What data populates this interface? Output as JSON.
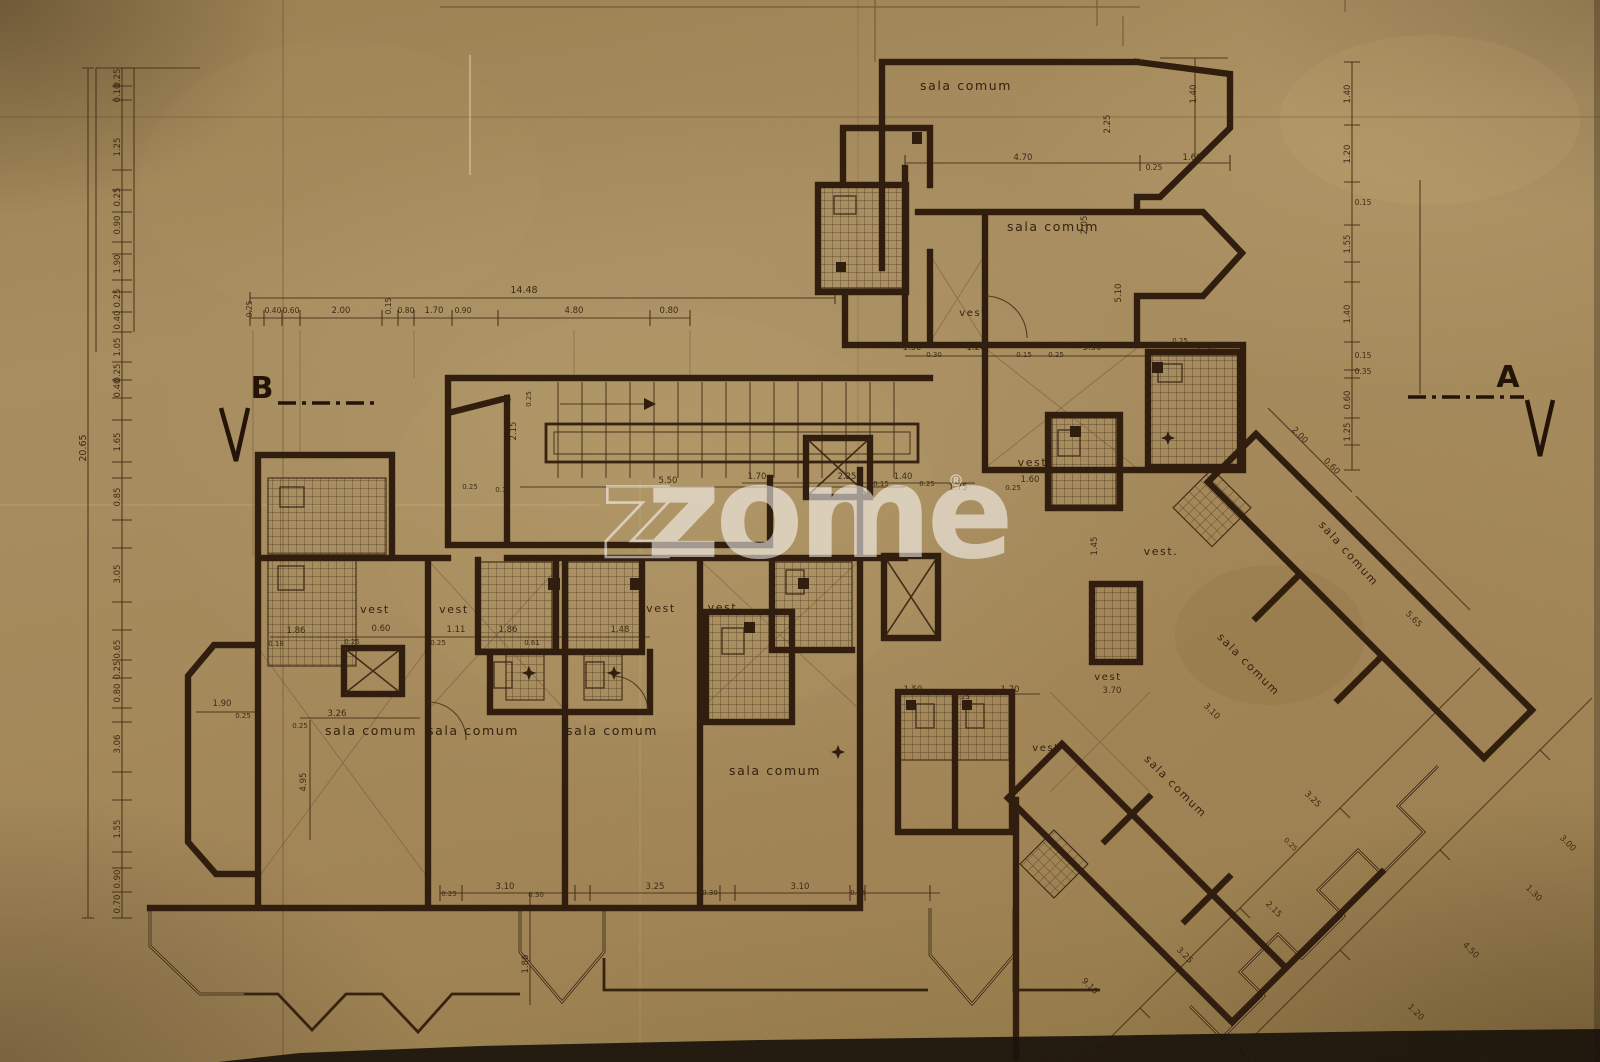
{
  "meta": {
    "drawing_type": "Scanned architectural floor plan blueprint",
    "paper_color": "#a78c5e",
    "ink_color": "#2e1b0c"
  },
  "watermark": {
    "z_outline": "z",
    "text": "zome",
    "registered": "®"
  },
  "section_markers": {
    "left": {
      "label": "B"
    },
    "right": {
      "label": "A"
    }
  },
  "room_labels": [
    {
      "t": "sala comum",
      "x": 966,
      "y": 90
    },
    {
      "t": "sala comum",
      "x": 1053,
      "y": 231
    },
    {
      "t": "vest",
      "x": 973,
      "y": 316,
      "s": 10
    },
    {
      "t": "vest.",
      "x": 1035,
      "y": 466,
      "s": 11
    },
    {
      "t": "vest.",
      "x": 1161,
      "y": 555,
      "s": 11
    },
    {
      "t": "vest",
      "x": 1108,
      "y": 680,
      "s": 10
    },
    {
      "t": "vest",
      "x": 1046,
      "y": 751,
      "s": 10
    },
    {
      "t": "vest",
      "x": 375,
      "y": 613,
      "s": 11
    },
    {
      "t": "vest",
      "x": 454,
      "y": 613,
      "s": 11
    },
    {
      "t": "vest",
      "x": 661,
      "y": 612,
      "s": 11
    },
    {
      "t": "vest.",
      "x": 725,
      "y": 611,
      "s": 11
    },
    {
      "t": "sala comum",
      "x": 371,
      "y": 735
    },
    {
      "t": "sala comum",
      "x": 473,
      "y": 735
    },
    {
      "t": "sala comum",
      "x": 612,
      "y": 735
    },
    {
      "t": "sala comum",
      "x": 775,
      "y": 775
    },
    {
      "t": "sala comum",
      "x": 1346,
      "y": 556,
      "r": 48,
      "s": 11
    },
    {
      "t": "sala comum",
      "x": 1246,
      "y": 667,
      "r": 45,
      "s": 11
    },
    {
      "t": "sala comum",
      "x": 1173,
      "y": 789,
      "r": 45,
      "s": 11
    }
  ],
  "dimension_labels": [
    {
      "t": "0.25",
      "x": 120,
      "y": 78,
      "r": -90
    },
    {
      "t": "0.10",
      "x": 120,
      "y": 93,
      "r": -90
    },
    {
      "t": "1.25",
      "x": 120,
      "y": 147,
      "r": -90
    },
    {
      "t": "0.25",
      "x": 120,
      "y": 197,
      "r": -90
    },
    {
      "t": "0.90",
      "x": 120,
      "y": 225,
      "r": -90
    },
    {
      "t": "1.90",
      "x": 120,
      "y": 264,
      "r": -90
    },
    {
      "t": "0.25",
      "x": 120,
      "y": 298,
      "r": -90
    },
    {
      "t": "0.40",
      "x": 120,
      "y": 320,
      "r": -90
    },
    {
      "t": "1.05",
      "x": 120,
      "y": 347,
      "r": -90
    },
    {
      "t": "0.25",
      "x": 120,
      "y": 373,
      "r": -90
    },
    {
      "t": "0.40",
      "x": 120,
      "y": 388,
      "r": -90
    },
    {
      "t": "1.65",
      "x": 120,
      "y": 442,
      "r": -90
    },
    {
      "t": "0.85",
      "x": 120,
      "y": 497,
      "r": -90
    },
    {
      "t": "3.05",
      "x": 120,
      "y": 574,
      "r": -90
    },
    {
      "t": "0.65",
      "x": 120,
      "y": 649,
      "r": -90
    },
    {
      "t": "0.25",
      "x": 120,
      "y": 670,
      "r": -90
    },
    {
      "t": "0.80",
      "x": 120,
      "y": 693,
      "r": -90
    },
    {
      "t": "3.06",
      "x": 120,
      "y": 744,
      "r": -90
    },
    {
      "t": "1.55",
      "x": 120,
      "y": 829,
      "r": -90
    },
    {
      "t": "0.90",
      "x": 120,
      "y": 879,
      "r": -90
    },
    {
      "t": "0.70",
      "x": 120,
      "y": 904,
      "r": -90
    },
    {
      "t": "20.65",
      "x": 86,
      "y": 448,
      "r": -90,
      "s": 9.5
    },
    {
      "t": "14.48",
      "x": 524,
      "y": 293,
      "s": 9.5
    },
    {
      "t": "0.25",
      "x": 252,
      "y": 309,
      "r": -90,
      "s": 7.5
    },
    {
      "t": "0.40",
      "x": 273,
      "y": 313,
      "s": 7.5
    },
    {
      "t": "0.60",
      "x": 291,
      "y": 313,
      "s": 7.5
    },
    {
      "t": "2.00",
      "x": 341,
      "y": 313
    },
    {
      "t": "0.15",
      "x": 391,
      "y": 306,
      "r": -90,
      "s": 7.5
    },
    {
      "t": "0.80",
      "x": 406,
      "y": 313,
      "s": 7.5
    },
    {
      "t": "1.70",
      "x": 434,
      "y": 313
    },
    {
      "t": "0.90",
      "x": 463,
      "y": 313,
      "s": 7.5
    },
    {
      "t": "4.80",
      "x": 574,
      "y": 313
    },
    {
      "t": "0.80",
      "x": 669,
      "y": 313
    },
    {
      "t": "1.40",
      "x": 1350,
      "y": 94,
      "r": -90
    },
    {
      "t": "1.20",
      "x": 1350,
      "y": 154,
      "r": -90
    },
    {
      "t": "0.15",
      "x": 1363,
      "y": 205,
      "s": 7.5
    },
    {
      "t": "1.55",
      "x": 1350,
      "y": 244,
      "r": -90
    },
    {
      "t": "1.40",
      "x": 1350,
      "y": 314,
      "r": -90
    },
    {
      "t": "0.15",
      "x": 1363,
      "y": 358,
      "s": 7.5
    },
    {
      "t": "0.35",
      "x": 1363,
      "y": 374,
      "s": 7.5
    },
    {
      "t": "0.60",
      "x": 1350,
      "y": 400,
      "r": -90
    },
    {
      "t": "1.25",
      "x": 1350,
      "y": 432,
      "r": -90
    },
    {
      "t": "1.40",
      "x": 1196,
      "y": 94,
      "r": -90
    },
    {
      "t": "4.70",
      "x": 1023,
      "y": 160
    },
    {
      "t": "1.60",
      "x": 1192,
      "y": 160
    },
    {
      "t": "0.25",
      "x": 1154,
      "y": 170,
      "s": 7.5
    },
    {
      "t": "2.25",
      "x": 1110,
      "y": 124,
      "r": -90
    },
    {
      "t": "5.10",
      "x": 1121,
      "y": 293,
      "r": -90
    },
    {
      "t": "2.05",
      "x": 1087,
      "y": 225,
      "r": -90
    },
    {
      "t": "1.50",
      "x": 912,
      "y": 350
    },
    {
      "t": "0.30",
      "x": 934,
      "y": 357,
      "s": 7
    },
    {
      "t": "1.20",
      "x": 976,
      "y": 350
    },
    {
      "t": "0.15",
      "x": 1024,
      "y": 357,
      "s": 7
    },
    {
      "t": "3.50",
      "x": 1092,
      "y": 350
    },
    {
      "t": "0.25",
      "x": 1056,
      "y": 357,
      "s": 7
    },
    {
      "t": "1.58",
      "x": 1206,
      "y": 350
    },
    {
      "t": "0.25",
      "x": 1180,
      "y": 343,
      "s": 7
    },
    {
      "t": "5.50",
      "x": 668,
      "y": 483
    },
    {
      "t": "0.25",
      "x": 470,
      "y": 489,
      "s": 7
    },
    {
      "t": "0.15",
      "x": 503,
      "y": 492,
      "s": 7
    },
    {
      "t": "2.15",
      "x": 516,
      "y": 431,
      "r": -90
    },
    {
      "t": "0.25",
      "x": 531,
      "y": 399,
      "r": -90,
      "s": 7
    },
    {
      "t": "1.70",
      "x": 757,
      "y": 479
    },
    {
      "t": "2.25",
      "x": 847,
      "y": 479
    },
    {
      "t": "0.15",
      "x": 881,
      "y": 486,
      "s": 7
    },
    {
      "t": "1.40",
      "x": 903,
      "y": 479
    },
    {
      "t": "0.25",
      "x": 927,
      "y": 486,
      "s": 7
    },
    {
      "t": "1.75",
      "x": 958,
      "y": 490
    },
    {
      "t": "1.60",
      "x": 1030,
      "y": 482
    },
    {
      "t": "0.25",
      "x": 1013,
      "y": 490,
      "s": 7
    },
    {
      "t": "1.45",
      "x": 1097,
      "y": 546,
      "r": -90
    },
    {
      "t": "1.86",
      "x": 296,
      "y": 633
    },
    {
      "t": "0.18",
      "x": 276,
      "y": 646,
      "s": 7
    },
    {
      "t": "0.60",
      "x": 381,
      "y": 631
    },
    {
      "t": "0.25",
      "x": 352,
      "y": 644,
      "s": 7
    },
    {
      "t": "1.11",
      "x": 456,
      "y": 632
    },
    {
      "t": "0.25",
      "x": 438,
      "y": 645,
      "s": 7
    },
    {
      "t": "1.86",
      "x": 508,
      "y": 632
    },
    {
      "t": "0.61",
      "x": 532,
      "y": 645,
      "s": 7
    },
    {
      "t": "1.48",
      "x": 620,
      "y": 632
    },
    {
      "t": "3.26",
      "x": 337,
      "y": 716
    },
    {
      "t": "0.25",
      "x": 300,
      "y": 728,
      "s": 7
    },
    {
      "t": "1.90",
      "x": 222,
      "y": 706
    },
    {
      "t": "0.25",
      "x": 243,
      "y": 718,
      "s": 7
    },
    {
      "t": "4.95",
      "x": 306,
      "y": 782,
      "r": -90
    },
    {
      "t": "1.50",
      "x": 913,
      "y": 692
    },
    {
      "t": "1.70",
      "x": 1010,
      "y": 692
    },
    {
      "t": "0.25",
      "x": 962,
      "y": 699,
      "s": 7
    },
    {
      "t": "0.25",
      "x": 449,
      "y": 896,
      "s": 7
    },
    {
      "t": "3.10",
      "x": 505,
      "y": 889
    },
    {
      "t": "0.30",
      "x": 536,
      "y": 897,
      "s": 7
    },
    {
      "t": "3.25",
      "x": 655,
      "y": 889
    },
    {
      "t": "0.30",
      "x": 710,
      "y": 895,
      "s": 7
    },
    {
      "t": "3.10",
      "x": 800,
      "y": 889
    },
    {
      "t": "0.25",
      "x": 858,
      "y": 895,
      "s": 7
    },
    {
      "t": "1.86",
      "x": 528,
      "y": 964,
      "r": -90
    },
    {
      "t": "2.00",
      "x": 1298,
      "y": 437,
      "r": 45
    },
    {
      "t": "0.60",
      "x": 1330,
      "y": 468,
      "r": 45
    },
    {
      "t": "5.65",
      "x": 1412,
      "y": 621,
      "r": 45
    },
    {
      "t": "3.70",
      "x": 1112,
      "y": 693
    },
    {
      "t": "3.10",
      "x": 1210,
      "y": 713,
      "r": 45
    },
    {
      "t": "3.25",
      "x": 1311,
      "y": 801,
      "r": 45
    },
    {
      "t": "0.25",
      "x": 1289,
      "y": 846,
      "r": 45,
      "s": 7
    },
    {
      "t": "2.15",
      "x": 1272,
      "y": 911,
      "r": 45
    },
    {
      "t": "3.25",
      "x": 1183,
      "y": 957,
      "r": 45
    },
    {
      "t": "9.10",
      "x": 1088,
      "y": 988,
      "r": 45
    },
    {
      "t": "1.20",
      "x": 1414,
      "y": 1014,
      "r": 45
    },
    {
      "t": "4.50",
      "x": 1469,
      "y": 952,
      "r": 45
    },
    {
      "t": "1.30",
      "x": 1532,
      "y": 895,
      "r": 45
    },
    {
      "t": "3.00",
      "x": 1566,
      "y": 845,
      "r": 45
    }
  ]
}
